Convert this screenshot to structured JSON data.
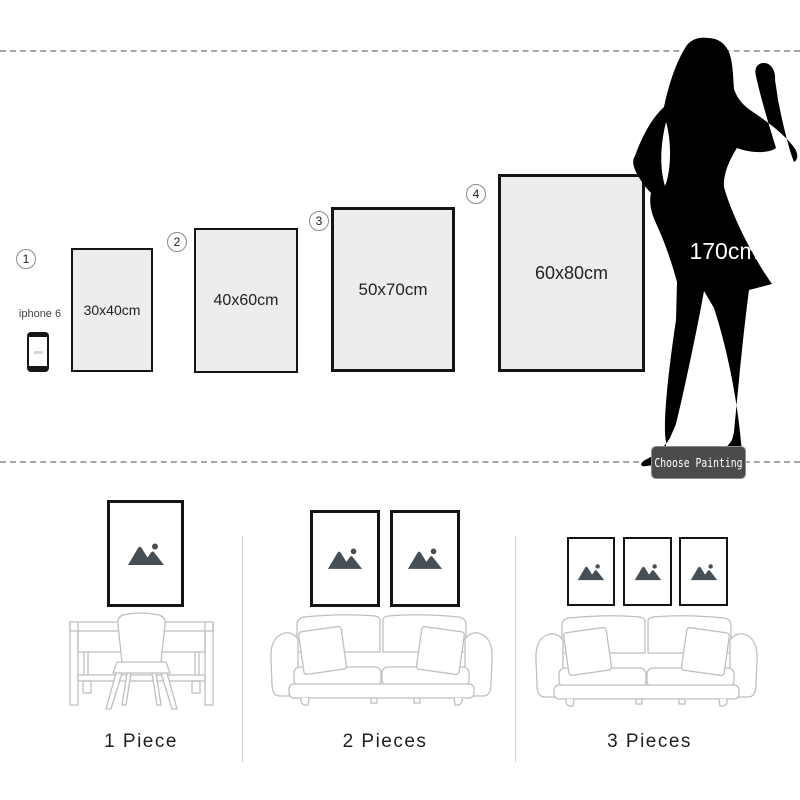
{
  "top": {
    "phone_label": "iphone 6",
    "frames": [
      {
        "number": "1",
        "size": "30x40cm"
      },
      {
        "number": "2",
        "size": "40x60cm"
      },
      {
        "number": "3",
        "size": "50x70cm"
      },
      {
        "number": "4",
        "size": "60x80cm"
      }
    ],
    "model_height": "170cm",
    "button_label": "Choose Painting"
  },
  "bottom": {
    "options": [
      {
        "label": "1 Piece",
        "frame_count": 1,
        "furniture": "desk with chair"
      },
      {
        "label": "2 Pieces",
        "frame_count": 2,
        "furniture": "sofa"
      },
      {
        "label": "3 Pieces",
        "frame_count": 3,
        "furniture": "sofa"
      }
    ]
  },
  "colors": {
    "frame_border": "#141414",
    "frame_fill": "#ededed",
    "silhouette": "#000000",
    "button_bg": "#4b4b4b",
    "button_text": "#ffffff",
    "placeholder_icon": "#474f56",
    "furniture_line": "#bfbfbf",
    "dashed_line": "#a6a6a6"
  }
}
